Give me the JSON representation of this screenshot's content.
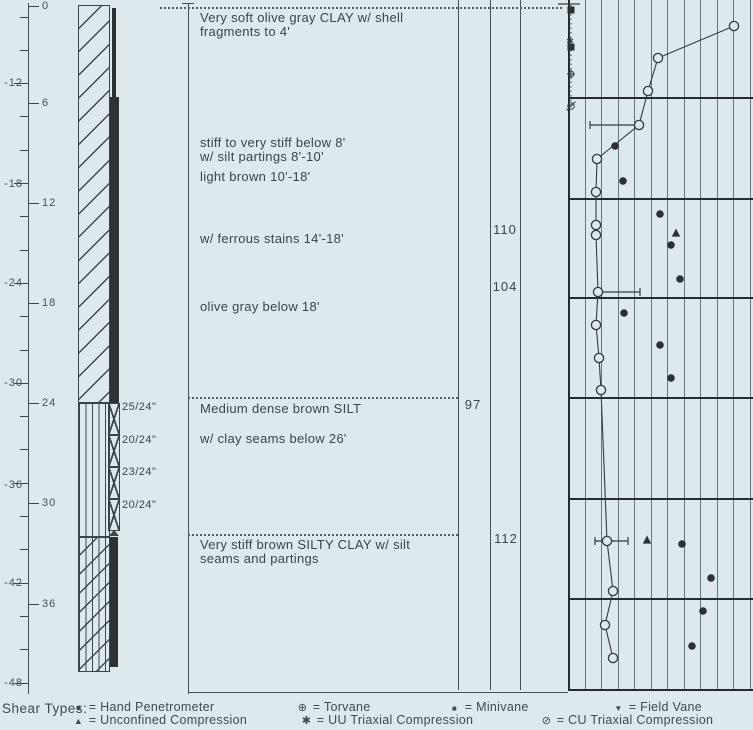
{
  "window": {
    "width": 753,
    "height": 730,
    "bg": "#dde9ec"
  },
  "colors": {
    "paper": "#dde9ec",
    "ink": "#3d4449",
    "dark_fill": "#2e3236",
    "grid": "#64777c",
    "bold_line": "#262c30"
  },
  "elevation_scale": {
    "axis_x": 28,
    "tick_start_y": 17,
    "tick_spacing": 33.3,
    "tick_count": 21,
    "labels": [
      {
        "text": "-12",
        "y": 83
      },
      {
        "text": "-18",
        "y": 184
      },
      {
        "text": "-24",
        "y": 283
      },
      {
        "text": "-30",
        "y": 383
      },
      {
        "text": "-36",
        "y": 485
      },
      {
        "text": "-42",
        "y": 583
      },
      {
        "text": "-48",
        "y": 683
      }
    ]
  },
  "depth_scale": {
    "labels": [
      {
        "text": "0",
        "y": 6
      },
      {
        "text": "6",
        "y": 103
      },
      {
        "text": "12",
        "y": 203
      },
      {
        "text": "18",
        "y": 303
      },
      {
        "text": "24",
        "y": 403
      },
      {
        "text": "30",
        "y": 503
      },
      {
        "text": "36",
        "y": 604
      }
    ]
  },
  "lithology": {
    "column": {
      "x": 78,
      "pattern_w": 32,
      "top": 5,
      "bottom": 672
    },
    "sections": [
      {
        "name": "clay",
        "pattern": "clay",
        "y1": 5,
        "y2": 403
      },
      {
        "name": "silt",
        "pattern": "silt",
        "y1": 403,
        "y2": 537
      },
      {
        "name": "silty-clay",
        "pattern": "silty-clay",
        "y1": 537,
        "y2": 672
      }
    ],
    "sample_strip": {
      "dark_segments": [
        {
          "x": 112,
          "y": 8,
          "w": 4,
          "h": 89
        },
        {
          "x": 110,
          "y": 97,
          "w": 9,
          "h": 306
        },
        {
          "x": 110,
          "y": 537,
          "w": 8,
          "h": 130
        }
      ],
      "x_box": {
        "x": 108,
        "w": 12,
        "h": 32
      },
      "x_boxes": [
        {
          "y": 403
        },
        {
          "y": 435
        },
        {
          "y": 467
        },
        {
          "y": 499
        }
      ]
    },
    "sample_labels": [
      {
        "text": "25/24\"",
        "y": 401
      },
      {
        "text": "20/24\"",
        "y": 434
      },
      {
        "text": "23/24\"",
        "y": 466
      },
      {
        "text": "20/24\"",
        "y": 499
      }
    ]
  },
  "descriptions": [
    {
      "text": "Very soft olive gray CLAY w/ shell",
      "y": 10
    },
    {
      "text": "fragments to 4'",
      "y": 24
    },
    {
      "text": "stiff to very stiff below 8'",
      "y": 135
    },
    {
      "text": "w/ silt partings 8'-10'",
      "y": 149
    },
    {
      "text": "light brown 10'-18'",
      "y": 169
    },
    {
      "text": "w/ ferrous stains 14'-18'",
      "y": 231
    },
    {
      "text": "olive gray below 18'",
      "y": 299
    },
    {
      "text": "Medium dense brown SILT",
      "y": 401
    },
    {
      "text": "w/ clay seams below 26'",
      "y": 431
    },
    {
      "text": "Very stiff brown SILTY CLAY w/ silt",
      "y": 537
    },
    {
      "text": "seams and partings",
      "y": 551
    }
  ],
  "unit_weights": [
    {
      "value": "110",
      "x": 505,
      "y": 230
    },
    {
      "value": "104",
      "x": 505,
      "y": 287
    },
    {
      "value": "97",
      "x": 473,
      "y": 405
    },
    {
      "value": "112",
      "x": 506,
      "y": 539
    }
  ],
  "legend": {
    "title": "Shear Types:",
    "row_ys": [
      700,
      713
    ],
    "rows": [
      [
        {
          "symbol": "filled-circle",
          "label": "Hand Penetrometer",
          "x": 72
        },
        {
          "symbol": "torvane",
          "label": "Torvane",
          "x": 296
        },
        {
          "symbol": "filled-square",
          "label": "Minivane",
          "x": 448
        },
        {
          "symbol": "field-vane",
          "label": "Field Vane",
          "x": 612
        }
      ],
      [
        {
          "symbol": "up-triangle",
          "label": "Unconfined Compression",
          "x": 72
        },
        {
          "symbol": "star",
          "label": "UU Triaxial Compression",
          "x": 300
        },
        {
          "symbol": "cu-symbol",
          "label": "CU Triaxial Compression",
          "x": 540
        }
      ]
    ]
  },
  "chart_data": {
    "type": "scatter",
    "title": "Shear strength vs depth (boring log strength plot; x-axis labels cropped out of view)",
    "area": {
      "x_left": 568,
      "x_right": 753,
      "y_top": 0,
      "y_bottom": 689
    },
    "grid": {
      "x_start": 568,
      "spacing": 16.5,
      "count": 12,
      "section_line_ys": [
        97,
        198,
        297,
        397,
        498,
        598
      ]
    },
    "depth_axis": {
      "px_per_ft": 16.65,
      "depth0_y": 5
    },
    "series": [
      {
        "name": "connected profile",
        "symbol": "open-circle",
        "connected": true,
        "points": [
          [
            734,
            26
          ],
          [
            658,
            58
          ],
          [
            648,
            91
          ],
          [
            639,
            125
          ],
          [
            597,
            159
          ],
          [
            596,
            192
          ],
          [
            596,
            225
          ],
          [
            596,
            235
          ],
          [
            598,
            292
          ],
          [
            596,
            325
          ],
          [
            599,
            358
          ],
          [
            601,
            390
          ],
          [
            607,
            541
          ],
          [
            613,
            591
          ],
          [
            605,
            625
          ],
          [
            613,
            658
          ]
        ],
        "depths_ft": [
          1.3,
          3.2,
          5.2,
          7.2,
          9.2,
          11.2,
          13.2,
          13.8,
          17.2,
          19.2,
          21.2,
          23.1,
          32.2,
          35.2,
          37.2,
          39.2
        ]
      },
      {
        "name": "Hand Penetrometer",
        "symbol": "filled-circle",
        "connected": false,
        "points": [
          [
            615,
            146
          ],
          [
            623,
            181
          ],
          [
            660,
            214
          ],
          [
            671,
            245
          ],
          [
            680,
            279
          ],
          [
            624,
            313
          ],
          [
            660,
            345
          ],
          [
            671,
            378
          ],
          [
            682,
            544
          ],
          [
            711,
            578
          ],
          [
            703,
            611
          ],
          [
            692,
            646
          ]
        ],
        "depths_ft": [
          8.5,
          10.6,
          12.5,
          14.4,
          16.4,
          18.5,
          20.4,
          22.4,
          32.3,
          34.4,
          36.4,
          38.5
        ]
      },
      {
        "name": "Unconfined Compression",
        "symbol": "up-triangle",
        "connected": false,
        "points": [
          [
            676,
            233
          ],
          [
            647,
            540
          ]
        ],
        "depths_ft": [
          13.7,
          32.1
        ]
      },
      {
        "name": "Minivane",
        "symbol": "filled-square",
        "connected": false,
        "points": [
          [
            571,
            10
          ],
          [
            571,
            47
          ]
        ],
        "depths_ft": [
          0.3,
          2.5
        ]
      },
      {
        "name": "UU Triaxial Compression",
        "symbol": "star",
        "connected": false,
        "points": [
          [
            570,
            41
          ]
        ],
        "depths_ft": [
          2.2
        ]
      },
      {
        "name": "Torvane",
        "symbol": "torvane",
        "connected": false,
        "points": [
          [
            571,
            74
          ]
        ],
        "depths_ft": [
          4.1
        ]
      },
      {
        "name": "CU Triaxial Compression",
        "symbol": "cu-symbol",
        "connected": false,
        "points": [
          [
            571,
            106
          ]
        ],
        "depths_ft": [
          6.1
        ]
      }
    ],
    "error_bars": [
      {
        "y": 125,
        "x1": 590,
        "x2": 639,
        "caps": "left"
      },
      {
        "y": 292,
        "x1": 598,
        "x2": 640,
        "caps": "right"
      },
      {
        "y": 541,
        "x1": 595,
        "x2": 628,
        "caps": "both"
      }
    ],
    "dotted_line": {
      "x": 571,
      "y1": 5,
      "y2": 106
    },
    "top_tick": {
      "x1": 558,
      "x2": 580,
      "y": 4
    }
  }
}
